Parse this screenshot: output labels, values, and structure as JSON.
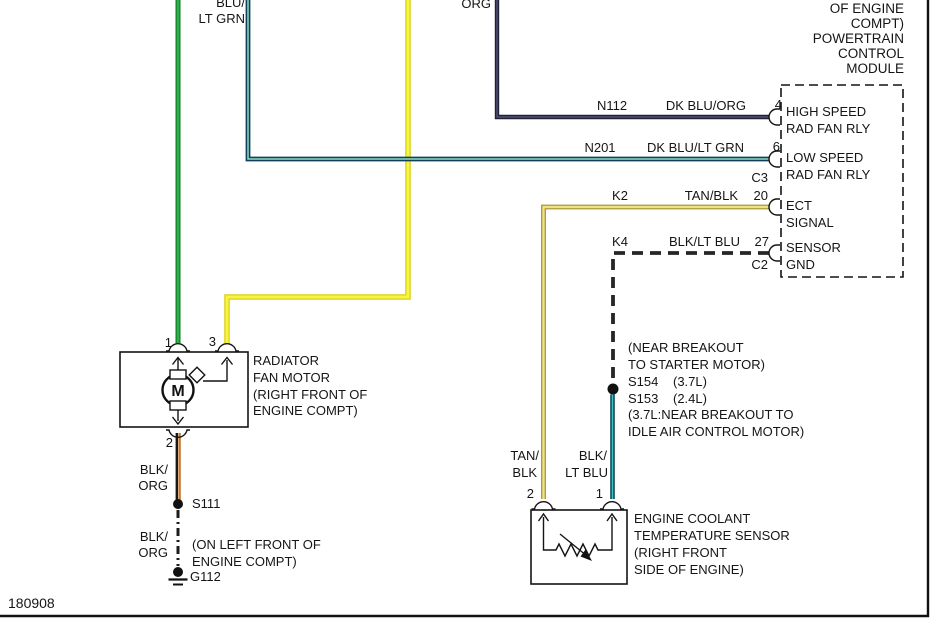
{
  "diagram_id": "180908",
  "top_wire_labels": {
    "left_clipped": "BLU/",
    "left": "LT GRN",
    "mid": "ORG"
  },
  "pcm": {
    "title_lines": [
      "OF ENGINE",
      "COMPT)",
      "POWERTRAIN",
      "CONTROL",
      "MODULE"
    ],
    "rows": [
      {
        "circuit": "N112",
        "color": "DK BLU/ORG",
        "pin": "4",
        "fn1": "HIGH SPEED",
        "fn2": "RAD FAN RLY"
      },
      {
        "circuit": "N201",
        "color": "DK BLU/LT GRN",
        "pin": "6",
        "fn1": "LOW SPEED",
        "fn2": "RAD FAN RLY"
      },
      {
        "circuit": "K2",
        "color": "TAN/BLK",
        "pin": "20",
        "fn1": "ECT",
        "fn2": "SIGNAL"
      },
      {
        "circuit": "K4",
        "color": "BLK/LT BLU",
        "pin": "27",
        "fn1": "SENSOR",
        "fn2": "GND"
      }
    ],
    "connector_c3": "C3",
    "connector_c2": "C2"
  },
  "fan_motor": {
    "pin1": "1",
    "pin3": "3",
    "pin2": "2",
    "motor_letter": "M",
    "label_lines": [
      "RADIATOR",
      "FAN MOTOR",
      "(RIGHT FRONT OF",
      "ENGINE COMPT)"
    ]
  },
  "ground_run": {
    "wire_top_1": "BLK/",
    "wire_top_2": "ORG",
    "splice": "S111",
    "wire_bot_1": "BLK/",
    "wire_bot_2": "ORG",
    "location_1": "(ON LEFT FRONT OF",
    "location_2": "ENGINE COMPT)",
    "ground": "G112"
  },
  "breakout": {
    "line1": "(NEAR BREAKOUT",
    "line2": "TO STARTER MOTOR)",
    "s1": "S154",
    "s1_eng": "(3.7L)",
    "s2": "S153",
    "s2_eng": "(2.4L)",
    "line5": "(3.7L:NEAR BREAKOUT TO",
    "line6": "IDLE AIR CONTROL MOTOR)"
  },
  "ect_sensor": {
    "w2_1": "TAN/",
    "w2_2": "BLK",
    "w1_1": "BLK/",
    "w1_2": "LT BLU",
    "pin2": "2",
    "pin1": "1",
    "label_lines": [
      "ENGINE COOLANT",
      "TEMPERATURE SENSOR",
      "(RIGHT FRONT",
      "SIDE OF ENGINE)"
    ]
  },
  "colors": {
    "green": "#2cb14b",
    "green_dk": "#127a26",
    "yellow": "#f8f344",
    "yellow_dk": "#d9d010",
    "navy": "#20203c",
    "navy_lt": "#5d5d7a",
    "dk_blu": "#143f5c",
    "lt_grn": "#8adfc3",
    "tan": "#f0e187",
    "tan_dk": "#a1902f",
    "orange": "#c9782b",
    "teal_dk": "#0e4a52",
    "lt_blu": "#3fc0c6",
    "black": "#1a1a1a"
  }
}
